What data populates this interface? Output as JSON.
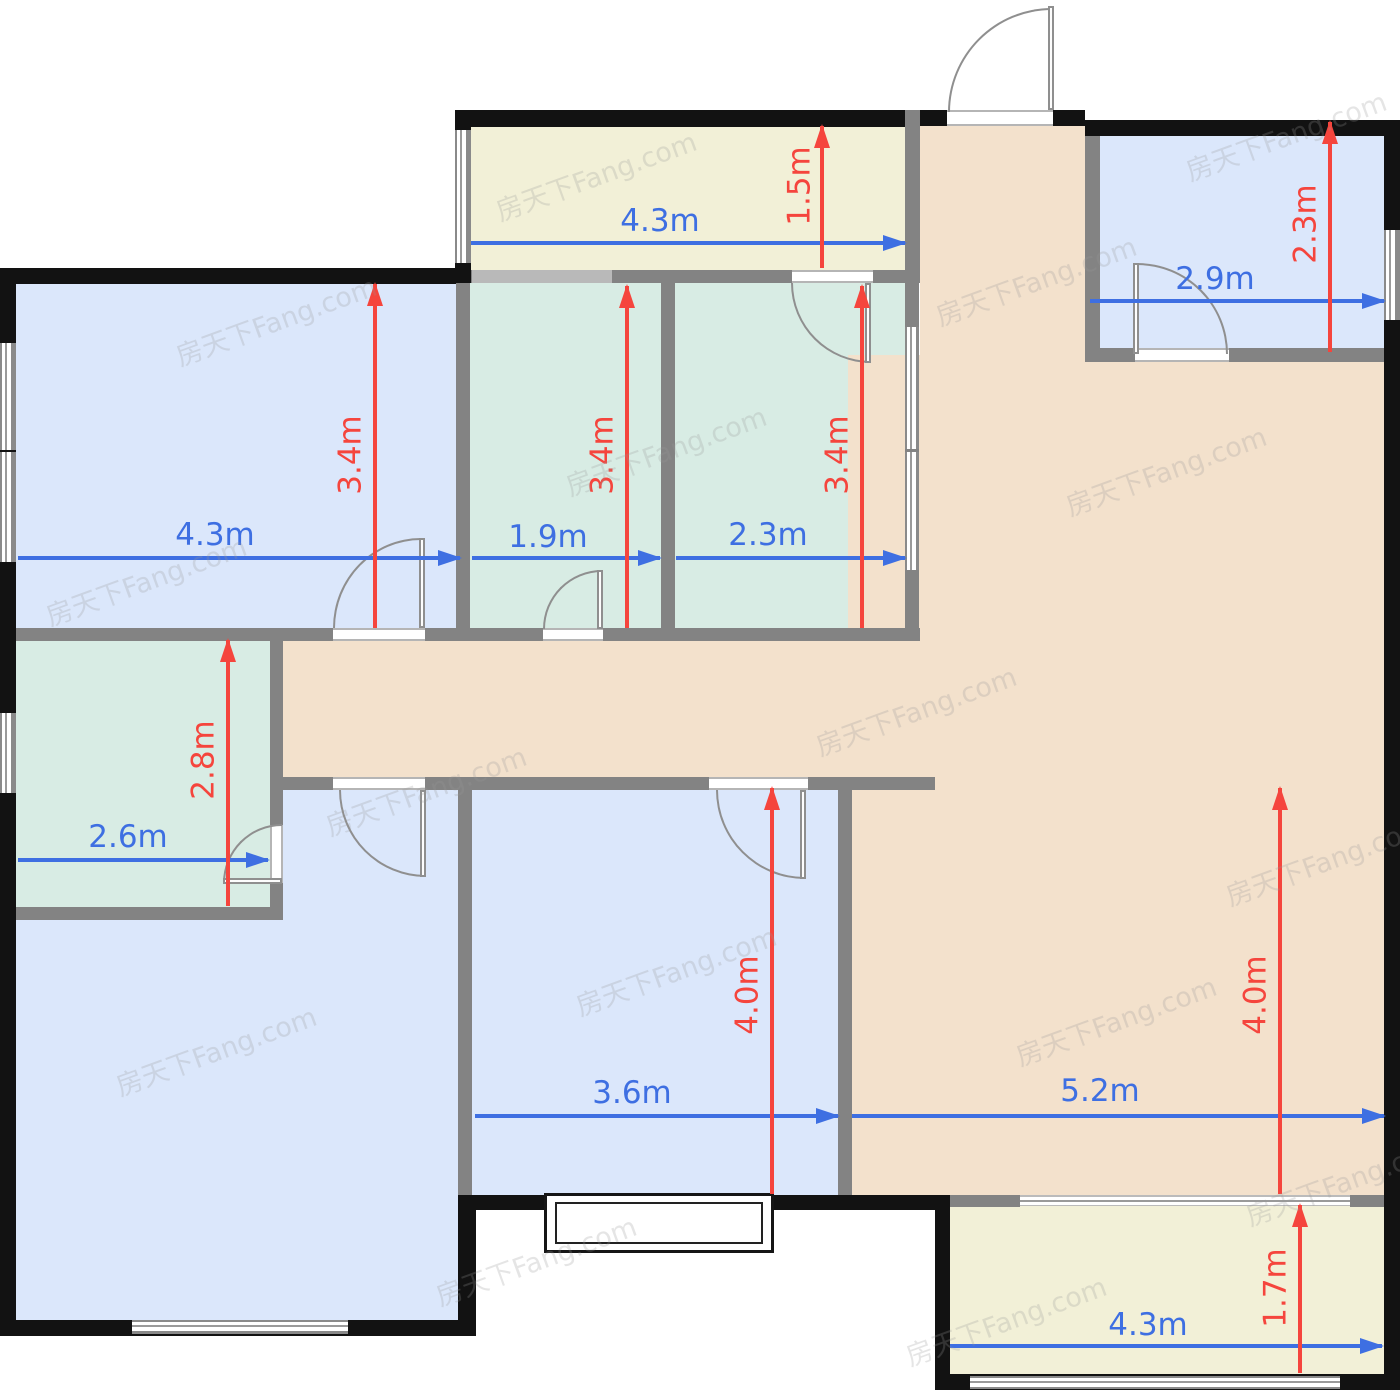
{
  "watermark": {
    "text": "房天下Fang.com"
  },
  "colors": {
    "bedroom_fill": "#dbe7fb",
    "bathroom_fill": "#d8ece4",
    "living_fill": "#f3e1cc",
    "balcony_fill": "#f2f0d7",
    "exterior_wall": "#121212",
    "interior_wall": "#838383",
    "dim_width_arrow": "#3e6fe2",
    "dim_depth_arrow": "#f5453d"
  },
  "dimensions": {
    "balcony_top": {
      "width": "4.3m",
      "depth": "1.5m"
    },
    "bedroom_top_right": {
      "width": "2.9m",
      "depth": "2.3m"
    },
    "bedroom_left": {
      "width": "4.3m",
      "depth": "3.4m"
    },
    "bathroom_1": {
      "width": "1.9m",
      "depth": "3.4m"
    },
    "bathroom_2": {
      "width": "2.3m",
      "depth": "3.4m"
    },
    "bathroom_left": {
      "width": "2.6m",
      "depth": "2.8m"
    },
    "bedroom_bottom": {
      "width": "3.6m",
      "depth": "4.0m"
    },
    "living_room": {
      "width": "5.2m",
      "depth": "4.0m"
    },
    "balcony_bottom": {
      "width": "4.3m",
      "depth": "1.7m"
    }
  }
}
